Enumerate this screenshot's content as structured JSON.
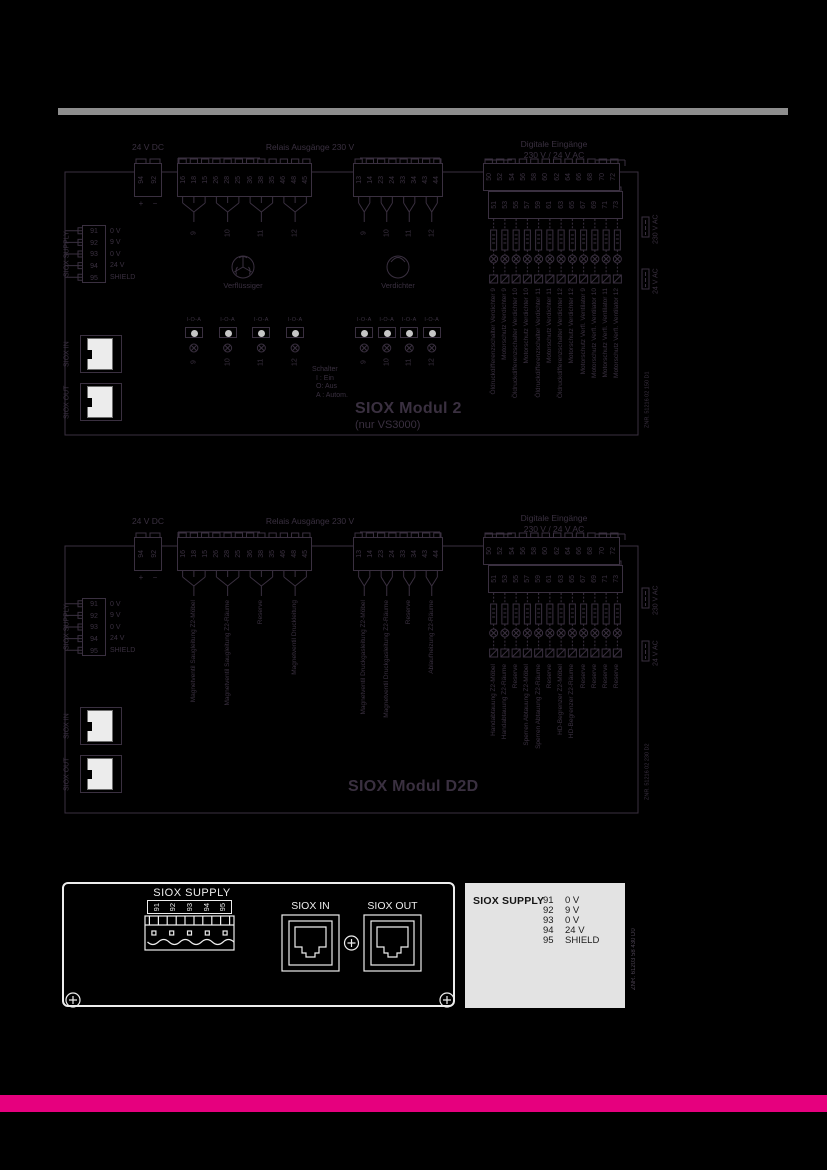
{
  "page": {
    "top_bar_color": "#8e8e8e",
    "accent_bar_color": "#e6007e",
    "diagram_ink": "#3a3040",
    "panel_ink": "#ededed",
    "legend_bg": "#e3e3e3"
  },
  "diagram_module2": {
    "dc_label": "24 V DC",
    "dc_terminals": [
      "94",
      "92"
    ],
    "dc_polarity_plus": "+",
    "dc_polarity_minus": "−",
    "relay_header": "Relais Ausgänge 230 V",
    "relay_terminals_changeover": [
      "16",
      "18",
      "15",
      "26",
      "28",
      "25",
      "36",
      "38",
      "35",
      "46",
      "48",
      "45"
    ],
    "relay_terminals_no": [
      "13",
      "14",
      "23",
      "24",
      "33",
      "34",
      "43",
      "44"
    ],
    "relay_outputs_left": [
      "9",
      "10",
      "11",
      "12"
    ],
    "relay_outputs_right": [
      "9",
      "10",
      "11",
      "12"
    ],
    "fan_label": "Verflüssiger",
    "compressor_label": "Verdichter",
    "digital_header": [
      "Digitale Eingänge",
      "230 V / 24 V AC"
    ],
    "digital_terminals_top": [
      "50",
      "52",
      "54",
      "56",
      "58",
      "60",
      "62",
      "64",
      "66",
      "68",
      "70",
      "72"
    ],
    "digital_terminals_bottom": [
      "51",
      "53",
      "55",
      "57",
      "59",
      "61",
      "63",
      "65",
      "67",
      "69",
      "71",
      "73"
    ],
    "digital_input_labels": [
      "Öldruckdifferenzschalter Verdichter 9",
      "Motorschutz Verdichter 9",
      "Öldruckdifferenzschalter Verdichter 10",
      "Motorschutz Verdichter 10",
      "Öldruckdifferenzschalter Verdichter 11",
      "Motorschutz Verdichter 11",
      "Öldruckdifferenzschalter Verdichter 12",
      "Motorschutz Verdichter 12",
      "Motorschutz Verfl. Ventilator 9",
      "Motorschutz Verfl. Ventilator 10",
      "Motorschutz Verfl. Ventilator 11",
      "Motorschutz Verfl. Ventilator 12"
    ],
    "switch_label": "I-O-A",
    "switch_numbers": [
      "9",
      "10",
      "11",
      "12"
    ],
    "switch_legend": [
      "Schalter",
      "I : Ein",
      "O: Aus",
      "A : Autom."
    ],
    "voltage_note_230": "230 V AC",
    "voltage_note_24": "24 V AC",
    "siox_supply": {
      "label": "SIOX SUPPLY",
      "terminals": [
        "91",
        "92",
        "93",
        "94",
        "95"
      ],
      "values": [
        "0 V",
        "9 V",
        "0 V",
        "24 V",
        "SHIELD"
      ]
    },
    "siox_in_label": "SIOX IN",
    "siox_out_label": "SIOX OUT",
    "title": "SIOX Modul 2",
    "subtitle": "(nur VS3000)",
    "znr": "ZNR. 51216 02 150 D1"
  },
  "diagram_moduleD2D": {
    "dc_label": "24 V DC",
    "dc_terminals": [
      "94",
      "92"
    ],
    "dc_polarity_plus": "+",
    "dc_polarity_minus": "−",
    "relay_header": "Relais Ausgänge 230 V",
    "relay_terminals_changeover": [
      "16",
      "18",
      "15",
      "26",
      "28",
      "25",
      "36",
      "38",
      "35",
      "46",
      "48",
      "45"
    ],
    "relay_terminals_no": [
      "13",
      "14",
      "23",
      "24",
      "33",
      "34",
      "43",
      "44"
    ],
    "relay_output_labels_left": [
      "Magnetventil Saugleitung Z2-Möbel",
      "Magnetventil Saugleitung Z2-Räume",
      "Reserve",
      "Magnetventil Druckleitung"
    ],
    "relay_output_labels_right": [
      "Magnetventil Druckgasleitung Z2-Möbel",
      "Magnetventil Druckgasleitung Z2-Räume",
      "Reserve",
      "Ablaufheizung Z2-Räume"
    ],
    "digital_header": [
      "Digitale Eingänge",
      "230 V / 24 V AC"
    ],
    "digital_terminals_top": [
      "50",
      "52",
      "54",
      "56",
      "58",
      "60",
      "62",
      "64",
      "66",
      "68",
      "70",
      "72"
    ],
    "digital_terminals_bottom": [
      "51",
      "53",
      "55",
      "57",
      "59",
      "61",
      "63",
      "65",
      "67",
      "69",
      "71",
      "73"
    ],
    "digital_input_labels": [
      "Handabtauung Z2-Möbel",
      "Handabtauung Z2-Räume",
      "Reserve",
      "Sperren Abtauung Z2-Möbel",
      "Sperren Abtauung Z2-Räume",
      "Reserve",
      "HD-Begrenzer Z2-Möbel",
      "HD-Begrenzer Z2-Räume",
      "Reserve",
      "Reserve",
      "Reserve",
      "Reserve"
    ],
    "voltage_note_230": "230 V AC",
    "voltage_note_24": "24 V AC",
    "siox_supply": {
      "label": "SIOX SUPPLY",
      "terminals": [
        "91",
        "92",
        "93",
        "94",
        "95"
      ],
      "values": [
        "0 V",
        "9 V",
        "0 V",
        "24 V",
        "SHIELD"
      ]
    },
    "siox_in_label": "SIOX IN",
    "siox_out_label": "SIOX OUT",
    "title": "SIOX Modul D2D",
    "znr": "ZNR. 51216 02 230 D2"
  },
  "panel_drawing": {
    "supply_title": "SIOX SUPPLY",
    "supply_terminals": [
      "91",
      "92",
      "93",
      "94",
      "95"
    ],
    "in_label": "SIOX IN",
    "out_label": "SIOX OUT"
  },
  "legend_box": {
    "title": "SIOX SUPPLY",
    "rows": [
      [
        "91",
        "0 V"
      ],
      [
        "92",
        "9 V"
      ],
      [
        "93",
        "0 V"
      ],
      [
        "94",
        "24 V"
      ],
      [
        "95",
        "SHIELD"
      ]
    ],
    "znr": "ZNR. 61203 58 430 D0"
  }
}
